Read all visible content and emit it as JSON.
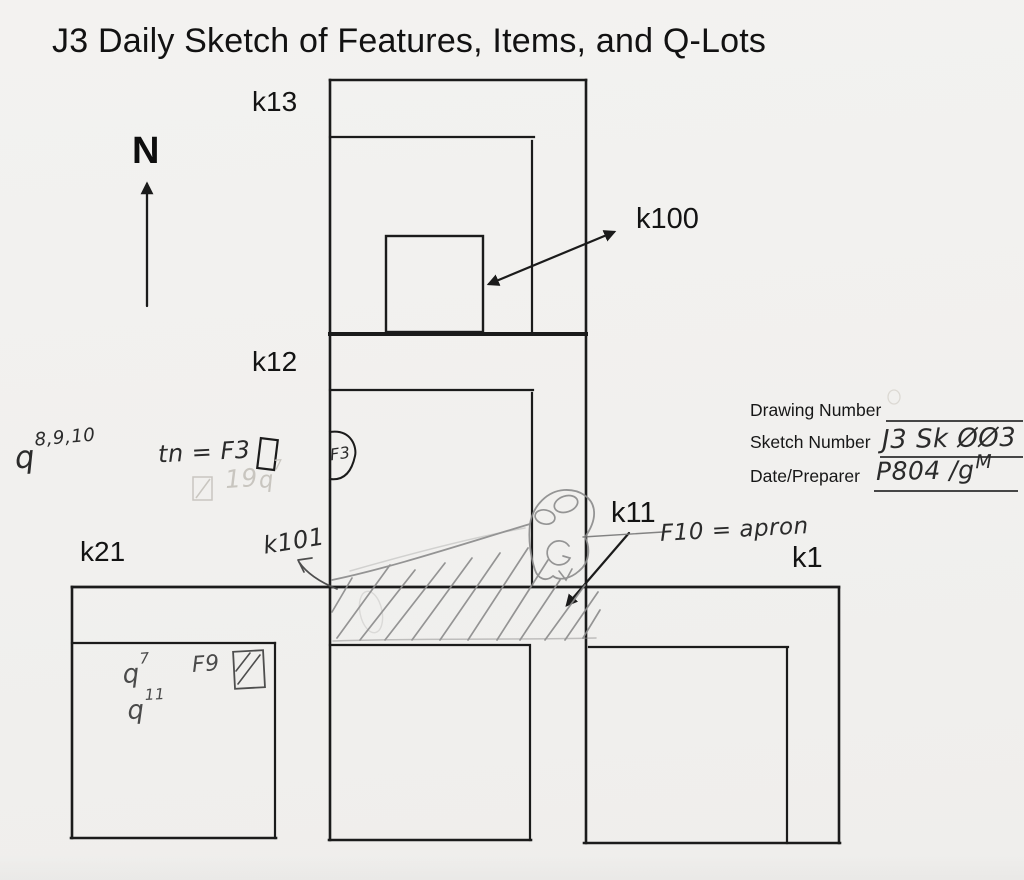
{
  "title": "J3 Daily Sketch of Features, Items, and Q-Lots",
  "compass": {
    "label": "N"
  },
  "unit_labels": {
    "k13": "k13",
    "k12": "k12",
    "k21": "k21",
    "k11": "k11",
    "k1": "k1"
  },
  "item_labels": {
    "k100": "k100",
    "k101": "k101"
  },
  "handwritten": {
    "q_list_base": "q",
    "q_list_sup": "8,9,10",
    "tn_equation": "tn = F3",
    "f3_bubble": "F3",
    "f10_equation": "F10 = apron",
    "k21_q7_base": "q",
    "k21_q7_sup": "7",
    "k21_f9": "F9",
    "k21_q11_base": "q",
    "k21_q11_sup": "11",
    "faint_pencil_19": "19",
    "faint_pencil_q7_base": "q",
    "faint_pencil_q7_sup": "7"
  },
  "form": {
    "drawing_label": "Drawing Number",
    "drawing_value": "",
    "sketch_label": "Sketch Number",
    "sketch_value": "J3 Sk ØØ3",
    "date_label": "Date/Preparer",
    "date_value": "P804 /g",
    "date_value_sup": "M"
  },
  "colors": {
    "ink": "#1b1b1b",
    "pencil": "#8b8b8b",
    "pencil_dark": "#4a4a4a",
    "paper": "#f1f0ee"
  }
}
